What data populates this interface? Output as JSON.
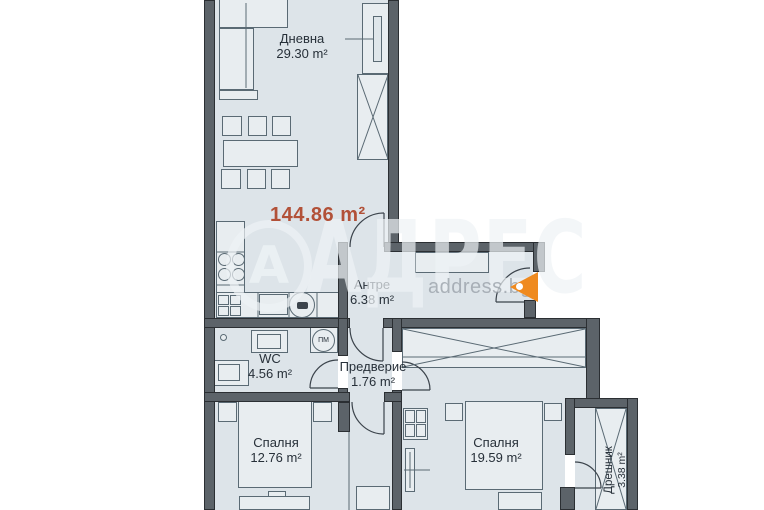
{
  "plan": {
    "total_area_label": "144.86 m²",
    "rooms": [
      {
        "name": "Дневна",
        "area": "29.30 m²"
      },
      {
        "name": "Антре",
        "area": "6.38 m²"
      },
      {
        "name": "WC",
        "area": "4.56 m²"
      },
      {
        "name": "Предверие",
        "area": "1.76 m²"
      },
      {
        "name": "Спалня",
        "area": "12.76 m²"
      },
      {
        "name": "Спалня",
        "area": "19.59 m²"
      },
      {
        "name": "Дрешник",
        "area": "3.38 m²"
      }
    ],
    "appliances": {
      "washer_label": "ПМ"
    },
    "watermark": {
      "brand": "АДРЕС",
      "logo_letter": "А",
      "site": "address.bg"
    },
    "colors": {
      "wall": "#5c6369",
      "room_fill": "#dde4e9",
      "area_accent": "#b25138",
      "entrance_marker": "#ef8a1f"
    }
  }
}
